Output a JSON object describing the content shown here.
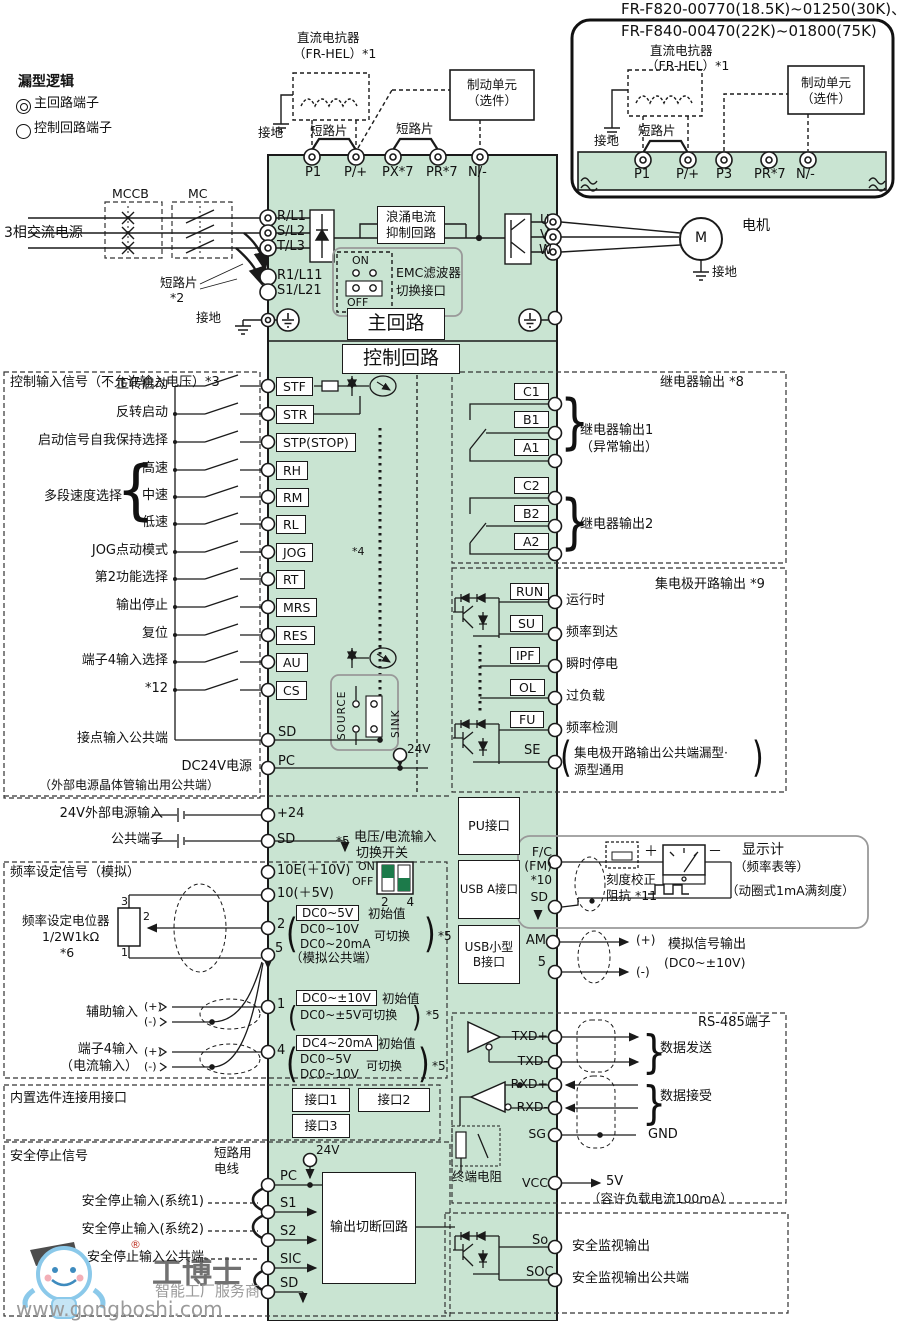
{
  "colors": {
    "band_green": "#c9e4d2",
    "dip_green": "#1c7a4a",
    "line": "#1a1a1a",
    "watermark_blue": "#7fc4e8"
  },
  "legend": {
    "title": "漏型逻辑",
    "main": "主回路端子",
    "ctrl": "控制回路端子"
  },
  "inset": {
    "model1": "FR-F820-00770(18.5K)~01250(30K)、",
    "model2": "FR-F840-00470(22K)~01800(75K)",
    "reactor1": "直流电抗器",
    "reactor2": "（FR-HEL）*1",
    "ground": "接地",
    "jumper": "短路片",
    "brake1": "制动单元",
    "brake2": "（选件）",
    "terminals": [
      "P1",
      "P/+",
      "P3",
      "PR*7",
      "N/-"
    ]
  },
  "topc": {
    "reactor1": "直流电抗器",
    "reactor2": "（FR-HEL）*1",
    "ground": "接地",
    "jumper1": "短路片",
    "jumper2": "短路片",
    "brake1": "制动单元",
    "brake2": "（选件）",
    "terminals": [
      "P1",
      "P/+",
      "PX*7",
      "PR*7",
      "N/-"
    ]
  },
  "main": {
    "mccb": "MCCB",
    "mc": "MC",
    "src": "3相交流电源",
    "jumper": "短路片",
    "jnote": "*2",
    "gnd": "接地",
    "r": "R/L1",
    "s": "S/L2",
    "t": "T/L3",
    "r1": "R1/L11",
    "s1": "S1/L21",
    "surge1": "浪涌电流",
    "surge2": "抑制回路",
    "on": "ON",
    "off": "OFF",
    "emc1": "EMC滤波器",
    "emc2": "切换接口",
    "title": "主回路",
    "u": "U",
    "v": "V",
    "w": "W",
    "motor": "M",
    "motor_lbl": "电机",
    "motor_gnd": "接地"
  },
  "ctrl": {
    "title": "控制回路",
    "header": "控制输入信号（不允许输入电压）*3",
    "rows": [
      {
        "l": "正转启动",
        "t": "STF"
      },
      {
        "l": "反转启动",
        "t": "STR"
      },
      {
        "l": "启动信号自我保持选择",
        "t": "STP(STOP)"
      },
      {
        "l": "高速",
        "t": "RH"
      },
      {
        "l": "中速",
        "t": "RM"
      },
      {
        "l": "低速",
        "t": "RL"
      },
      {
        "l": "JOG点动模式",
        "t": "JOG"
      },
      {
        "l": "第2功能选择",
        "t": "RT"
      },
      {
        "l": "输出停止",
        "t": "MRS"
      },
      {
        "l": "复位",
        "t": "RES"
      },
      {
        "l": "端子4输入选择",
        "t": "AU"
      },
      {
        "l": "*12",
        "t": "CS"
      }
    ],
    "group": "多段速度选择",
    "jog_note": "*4",
    "common_l": "接点输入公共端",
    "common_t": "SD",
    "dc24_1": "DC24V电源",
    "dc24_2": "（外部电源晶体管输出用公共端）",
    "pc": "PC",
    "source": "SOURCE",
    "sink": "SINK",
    "v24": "24V",
    "ext1": "24V外部电源输入",
    "ext1_t": "+24",
    "ext2": "公共端子",
    "ext2_t": "SD"
  },
  "sw": {
    "note": "*5",
    "l1": "电压/电流输入",
    "l2": "切换开关",
    "on": "ON",
    "off": "OFF",
    "nums": "2 4"
  },
  "analog": {
    "header": "频率设定信号（模拟）",
    "pot1": "频率设定电位器",
    "pot2": "1/2W1kΩ",
    "pot3": "*6",
    "p3": "3",
    "p2": "2",
    "p1": "1",
    "t10e": "10E(＋10V)",
    "t10": "10(＋5V)",
    "t2": "2",
    "t5": "5",
    "t5b": "（模拟公共端）",
    "t1": "1",
    "t4": "4",
    "v2": {
      "main": "DC0~5V",
      "init": "初始值",
      "a1": "DC0~10V",
      "a2": "DC0~20mA",
      "sw": "可切换",
      "note": "*5"
    },
    "v1": {
      "main": "DC0~±10V",
      "init": "初始值",
      "a1": "DC0~±5V可切换",
      "note": "*5"
    },
    "v4": {
      "main": "DC4~20mA",
      "init": "初始值",
      "a1": "DC0~5V",
      "a2": "DC0~10V",
      "sw": "可切换",
      "note": "*5"
    },
    "aux": "辅助输入",
    "aux_p": "(+)",
    "aux_m": "(-)",
    "t4l1": "端子4输入",
    "t4l2": "（电流输入）",
    "t4p": "(+)",
    "t4m": "(-)"
  },
  "opt": {
    "header": "内置选件连接用接口",
    "p1": "接口1",
    "p2": "接口2",
    "p3": "接口3"
  },
  "iface": {
    "pu": "PU接口",
    "usba": "USB A接口",
    "usbb1": "USB小型",
    "usbb2": "B接口"
  },
  "relay": {
    "header": "继电器输出 *8",
    "c1": "C1",
    "b1": "B1",
    "a1": "A1",
    "c2": "C2",
    "b2": "B2",
    "a2": "A2",
    "g1a": "继电器输出1",
    "g1b": "（异常输出）",
    "g2": "继电器输出2"
  },
  "oc": {
    "header": "集电极开路输出 *9",
    "rows": [
      {
        "t": "RUN",
        "l": "运行时"
      },
      {
        "t": "SU",
        "l": "频率到达"
      },
      {
        "t": "IPF",
        "l": "瞬时停电"
      },
      {
        "t": "OL",
        "l": "过负载"
      },
      {
        "t": "FU",
        "l": "频率检测"
      }
    ],
    "se": "SE",
    "se_l1": "集电极开路输出公共端漏型·",
    "se_l2": "源型通用"
  },
  "fm": {
    "fc": "F/C",
    "fmt": "(FM)",
    "note": "*10",
    "sd": "SD",
    "plus": "＋",
    "minus": "－",
    "disp1": "显示计",
    "disp2": "（频率表等）",
    "disp3": "（动圈式1mA满刻度）",
    "cal1": "刻度校正",
    "cal2": "阻抗 *11",
    "am": "AM",
    "five": "5",
    "out_p": "(+)",
    "out_m": "(-)",
    "out1": "模拟信号输出",
    "out2": "(DC0~±10V)"
  },
  "rs485": {
    "header": "RS-485端子",
    "txdp": "TXD+",
    "txdm": "TXD-",
    "send": "数据发送",
    "rxdp": "RXD+",
    "rxdm": "RXD-",
    "recv": "数据接受",
    "sg": "SG",
    "gnd": "GND",
    "term_res": "终端电阻",
    "vcc": "VCC",
    "v5": "5V",
    "load": "（容许负载电流100mA）"
  },
  "safety": {
    "header": "安全停止信号",
    "wire1": "短路用",
    "wire2": "电线",
    "v24": "24V",
    "pc": "PC",
    "s1": "S1",
    "s2": "S2",
    "sic": "SIC",
    "sd": "SD",
    "in1": "安全停止输入(系统1)",
    "in2": "安全停止输入(系统2)",
    "inc": "安全停止输入公共端",
    "box": "输出切断回路",
    "so": "So",
    "soc": "SOC",
    "so_l": "安全监视输出",
    "soc_l": "安全监视输出公共端"
  },
  "wm": {
    "r": "®",
    "name": "工博士",
    "tag": "智能工厂服务商",
    "url": "www.gongboshi.com"
  },
  "glyphs": {
    "brace_open": "{",
    "brace_close": "}",
    "paren_open": "(",
    "paren_close": ")"
  }
}
